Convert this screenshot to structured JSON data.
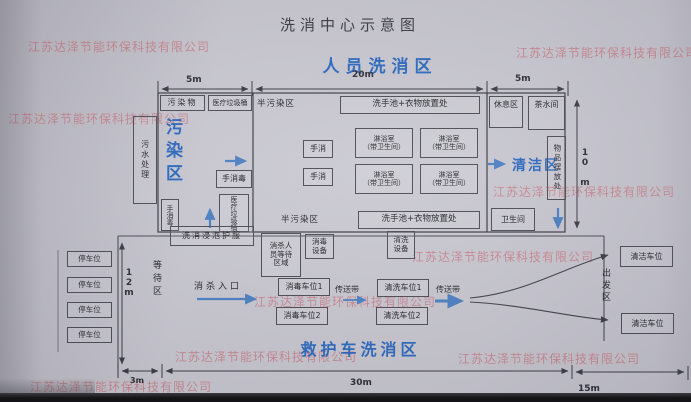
{
  "photo": {
    "watermark": "江苏达泽节能环保科技有限公司"
  },
  "title": "洗消中心示意图",
  "personnel": {
    "heading": "人员洗消区",
    "dims": {
      "left": "5m",
      "mid": "20m",
      "right": "5m",
      "height": "10 m"
    },
    "zones": {
      "polluted": "污染区",
      "semi": "半污染区",
      "clean": "清洁区"
    },
    "rooms": {
      "sewage": "污水处理",
      "pollutants": "污染物",
      "medical_bin": "医疗垃圾桶",
      "hand_disinfect": "手消毒",
      "hand_wash": "手消",
      "wash_station": "洗手池+衣物放置处",
      "shower": "淋浴室",
      "shower_note": "（带卫生间）",
      "rest": "休息区",
      "tea": "茶水间",
      "storage": "物品摆放处",
      "toilet": "卫生间",
      "soak": "洗消浸泡护服"
    }
  },
  "ambulance": {
    "heading": "救护车洗消区",
    "dims": {
      "height": "12m",
      "left": "3m",
      "mid": "30m",
      "right": "15m"
    },
    "labels": {
      "waiting_zone": "等待区",
      "entrance": "消杀入口",
      "staff_waiting": "消杀人\n员等待\n区域",
      "disinfect_equip": "消毒\n设备",
      "wash_equip": "清洗\n设备",
      "conveyor": "传送带",
      "departure": "出发区",
      "parking": "停车位",
      "disinfect_spot1": "消毒车位1",
      "disinfect_spot2": "消毒车位2",
      "wash_spot1": "清洗车位1",
      "wash_spot2": "清洗车位2",
      "clean_spot": "清洁车位"
    }
  }
}
